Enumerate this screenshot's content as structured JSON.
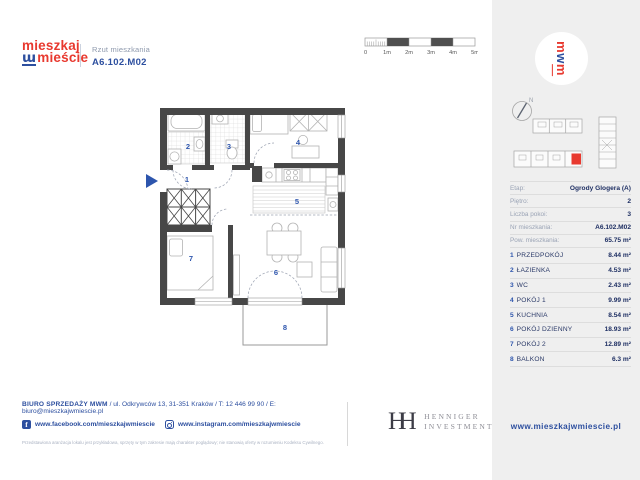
{
  "header": {
    "logo_line1": "mieszkaj",
    "logo_w": "ɯ",
    "logo_line2": "mieście",
    "doc_type": "Rzut mieszkania",
    "apartment_id": "A6.102.M02"
  },
  "scalebar": {
    "labels": [
      "0",
      "1m",
      "2m",
      "3m",
      "4m",
      "5m"
    ]
  },
  "sidebar": {
    "mwm_logo": {
      "m1": "m",
      "w": "w",
      "m2": "m"
    },
    "compass_north": "N",
    "info": [
      {
        "label": "Etap:",
        "value": "Ogrody Glogera (A)"
      },
      {
        "label": "Piętro:",
        "value": "2"
      },
      {
        "label": "Liczba pokoi:",
        "value": "3"
      },
      {
        "label": "Nr mieszkania:",
        "value": "A6.102.M02"
      },
      {
        "label": "Pow. mieszkania:",
        "value": "65.75 m²"
      }
    ],
    "rooms": [
      {
        "num": "1",
        "name": "PRZEDPOKÓJ",
        "area": "8.44 m²"
      },
      {
        "num": "2",
        "name": "ŁAZIENKA",
        "area": "4.53 m²"
      },
      {
        "num": "3",
        "name": "WC",
        "area": "2.43 m²"
      },
      {
        "num": "4",
        "name": "POKÓJ 1",
        "area": "9.99 m²"
      },
      {
        "num": "5",
        "name": "KUCHNIA",
        "area": "8.54 m²"
      },
      {
        "num": "6",
        "name": "POKÓJ DZIENNY",
        "area": "18.93 m²"
      },
      {
        "num": "7",
        "name": "POKÓJ 2",
        "area": "12.89 m²"
      },
      {
        "num": "8",
        "name": "BALKON",
        "area": "6.3 m²"
      }
    ],
    "website": "www.mieszkajwmiescie.pl"
  },
  "floorplan": {
    "room_numbers": [
      "1",
      "2",
      "3",
      "4",
      "5",
      "6",
      "7",
      "8"
    ]
  },
  "footer": {
    "office_bold": "BIURO SPRZEDAŻY MWM",
    "office_rest": " / ul. Odkrywców 13, 31-351 Kraków / T: 12 446 99 90 / E: biuro@mieszkajwmiescie.pl",
    "facebook_icon_glyph": "f",
    "facebook": "www.facebook.com/mieszkajwmiescie",
    "instagram": "www.instagram.com/mieszkajwmiescie",
    "disclaimer": "Przedstawiona aranżacja lokalu jest przykładowa, sprzęty w tym zakresie mają charakter poglądowy; nie stanowią oferty w rozumieniu Kodeksu Cywilnego.",
    "developer": {
      "mono1": "H",
      "mono2": "H",
      "line1": "HENNIGER",
      "line2": "INVESTMENT"
    }
  },
  "colors": {
    "brand_red": "#e8392f",
    "brand_blue": "#2d4f9f",
    "accent_blue": "#2d55ad",
    "navy": "#1e2f63",
    "muted_label": "#9aa3b5",
    "sidebar_bg": "#efefef",
    "wall": "#474747"
  }
}
